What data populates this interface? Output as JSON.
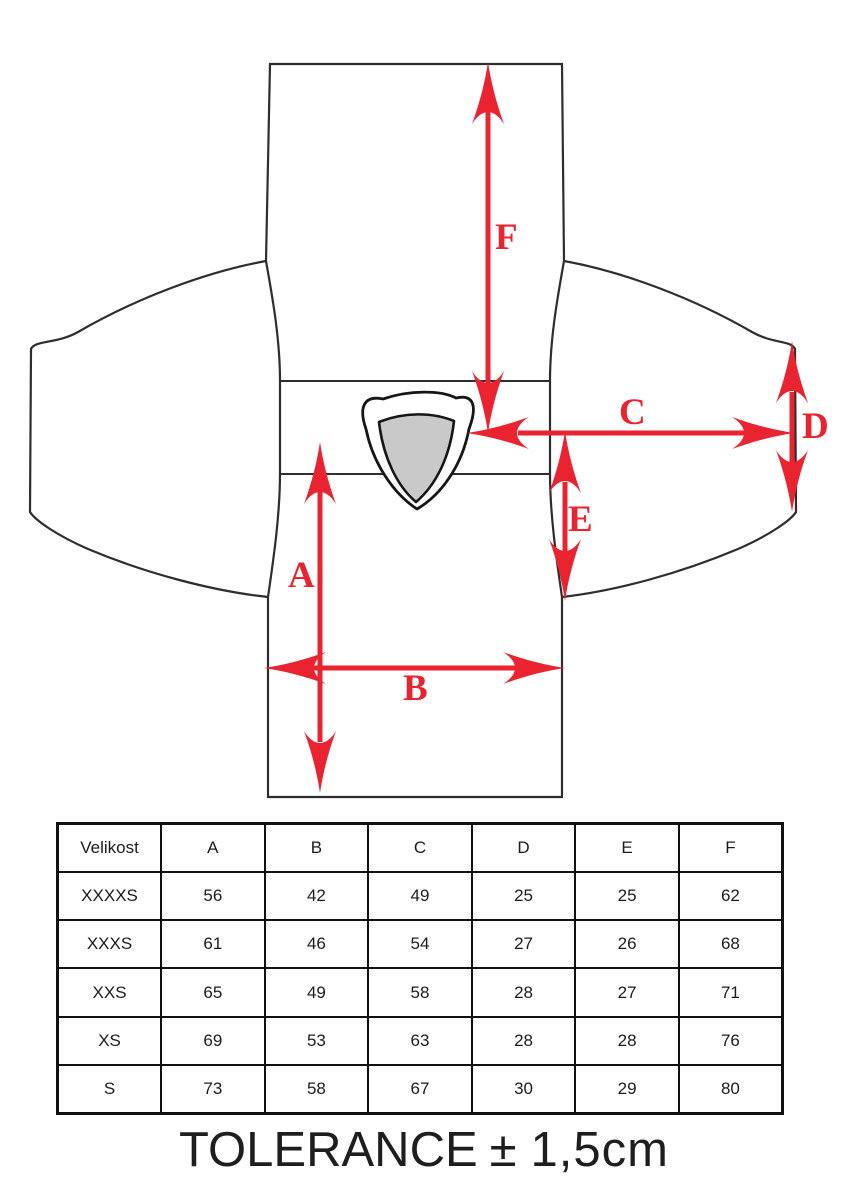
{
  "colors": {
    "arrow_red": "#ea2330",
    "collar_gray": "#c9c9c9",
    "outline": "#2e2e2e",
    "table_border": "#111111"
  },
  "diagram": {
    "description": "flat-laid jersey measurement diagram",
    "labels": {
      "A": "A",
      "B": "B",
      "C": "C",
      "D": "D",
      "E": "E",
      "F": "F"
    }
  },
  "table": {
    "header": [
      "Velikost",
      "A",
      "B",
      "C",
      "D",
      "E",
      "F"
    ],
    "rows": [
      [
        "XXXXS",
        "56",
        "42",
        "49",
        "25",
        "25",
        "62"
      ],
      [
        "XXXS",
        "61",
        "46",
        "54",
        "27",
        "26",
        "68"
      ],
      [
        "XXS",
        "65",
        "49",
        "58",
        "28",
        "27",
        "71"
      ],
      [
        "XS",
        "69",
        "53",
        "63",
        "28",
        "28",
        "76"
      ],
      [
        "S",
        "73",
        "58",
        "67",
        "30",
        "29",
        "80"
      ]
    ]
  },
  "footer": {
    "tolerance_label": "TOLERANCE",
    "plusminus": "±",
    "value": "1,5cm"
  }
}
